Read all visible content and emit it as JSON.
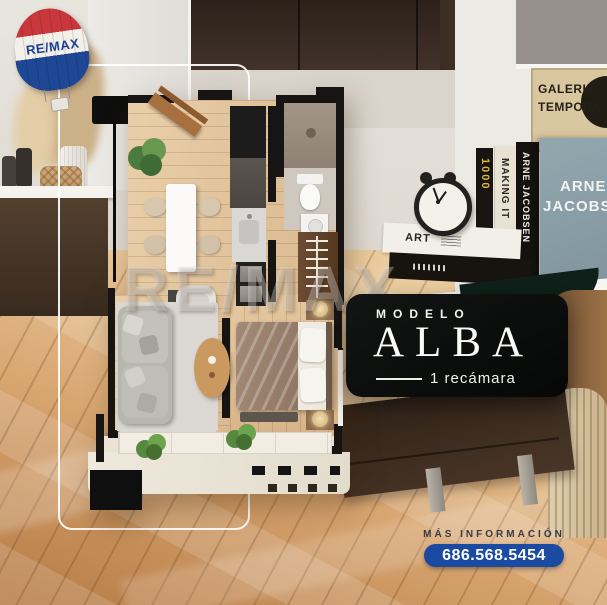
{
  "logo": {
    "text": "RE/MAX"
  },
  "watermark": {
    "text": "RE/MAX"
  },
  "model_badge": {
    "label": "MODELO",
    "name": "ALBA",
    "bedrooms": "1 recámara"
  },
  "contact": {
    "label": "MÁS INFORMACIÓN",
    "phone": "686.568.5454"
  },
  "decor": {
    "poster_line1": "GALERIE",
    "poster_line2": "TEMPORA",
    "book_spine_1": "1000",
    "book_spine_2": "MAKING IT",
    "book_spine_3": "ARNE JACOBSEN",
    "book_cover_line1": "ARNE",
    "book_cover_line2": "JACOBSEN",
    "book_art": "ART"
  },
  "colors": {
    "phone_pill_blue": "#1b4aa2",
    "balloon_red": "#c8373b",
    "balloon_blue": "#1e4795",
    "badge_bg": "#0a0c0a",
    "plan_wall": "#161513"
  }
}
